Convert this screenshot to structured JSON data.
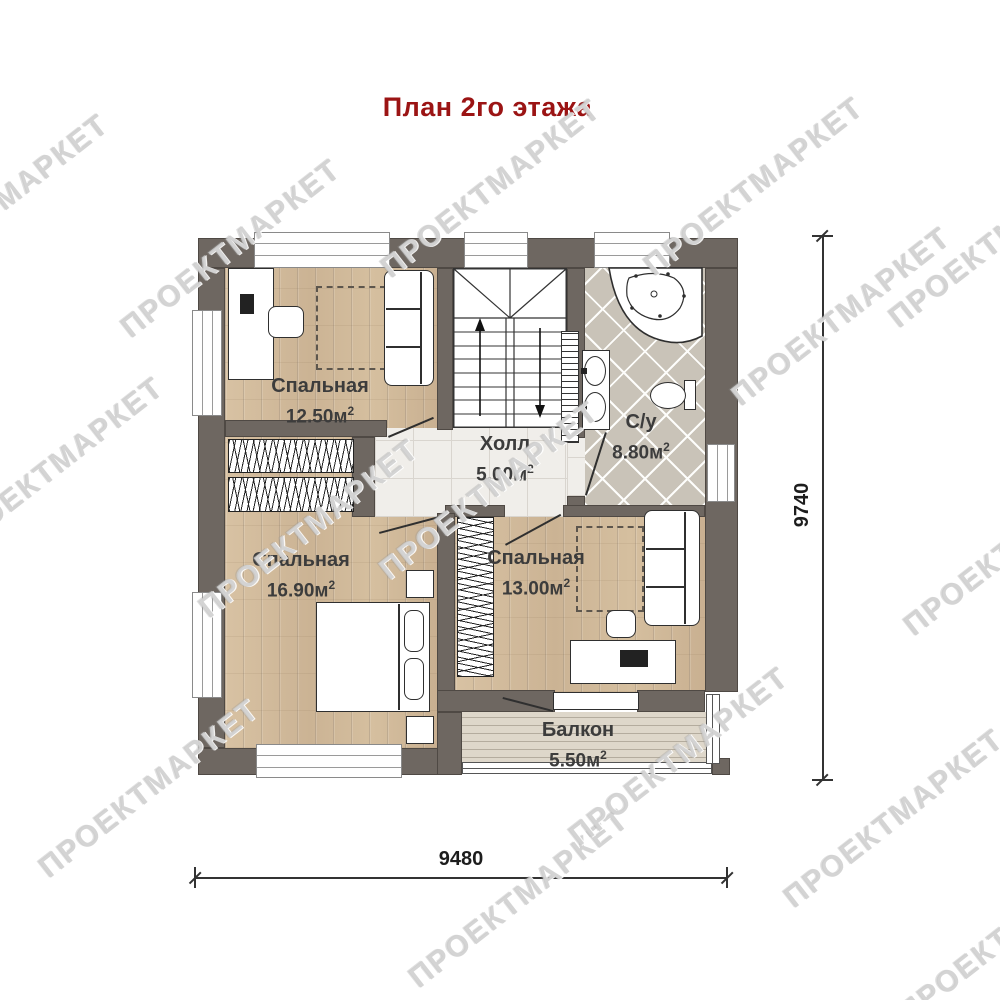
{
  "title": {
    "text": "План 2го этажа"
  },
  "watermark": {
    "text": "ПРОЕКТМАРКЕТ"
  },
  "rooms": [
    {
      "name": "Спальная",
      "area": "12.50м",
      "area_sup": "2"
    },
    {
      "name": "Холл",
      "area": "5.00м",
      "area_sup": "2"
    },
    {
      "name": "С/у",
      "area": "8.80м",
      "area_sup": "2"
    },
    {
      "name": "Спальная",
      "area": "16.90м",
      "area_sup": "2"
    },
    {
      "name": "Спальная",
      "area": "13.00м",
      "area_sup": "2"
    },
    {
      "name": "Балкон",
      "area": "5.50м",
      "area_sup": "2"
    }
  ],
  "dimensions": {
    "bottom": "9480",
    "right": "9740"
  },
  "colors": {
    "wall": "#6e6761",
    "title": "#9b1414",
    "wood_floor": "#d2bb9b",
    "bath_tile": "#c9c3b8",
    "hall_tile": "#f0eeea",
    "balcony_floor": "#ded7ca"
  }
}
